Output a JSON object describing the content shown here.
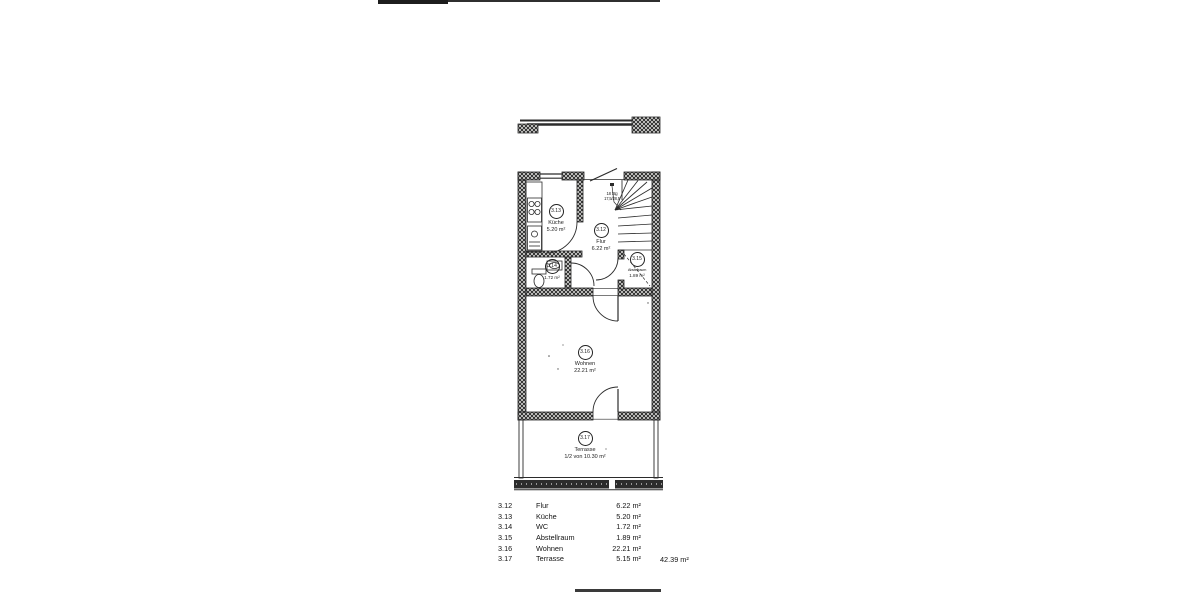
{
  "colors": {
    "ink": "#1f1f1f",
    "paper": "#ffffff"
  },
  "plan": {
    "rooms": {
      "flur": {
        "number": "3.12",
        "name": "Flur",
        "area": "6.22 m²"
      },
      "kueche": {
        "number": "3.13",
        "name": "Küche",
        "area": "5.20 m²"
      },
      "wc": {
        "number": "3.14",
        "name": "WC",
        "area": "1.72 m²"
      },
      "abstellraum": {
        "number": "3.15",
        "name": "Abstellraum",
        "area": "1.89 m²"
      },
      "wohnen": {
        "number": "3.16",
        "name": "Wohnen",
        "area": "22.21 m²"
      },
      "terrasse": {
        "number": "3.17",
        "name": "Terrasse",
        "area": "1/2 von 10.30 m²"
      }
    },
    "stairs": {
      "line1": "18 Stg",
      "line2": "17,5/28,5"
    }
  },
  "legend": {
    "rows": [
      {
        "id": "3.12",
        "name": "Flur",
        "area": "6.22 m²"
      },
      {
        "id": "3.13",
        "name": "Küche",
        "area": "5.20 m²"
      },
      {
        "id": "3.14",
        "name": "WC",
        "area": "1.72 m²"
      },
      {
        "id": "3.15",
        "name": "Abstellraum",
        "area": "1.89 m²"
      },
      {
        "id": "3.16",
        "name": "Wohnen",
        "area": "22.21 m²"
      },
      {
        "id": "3.17",
        "name": "Terrasse",
        "area": "5.15 m²"
      }
    ],
    "total": "42.39 m²"
  }
}
